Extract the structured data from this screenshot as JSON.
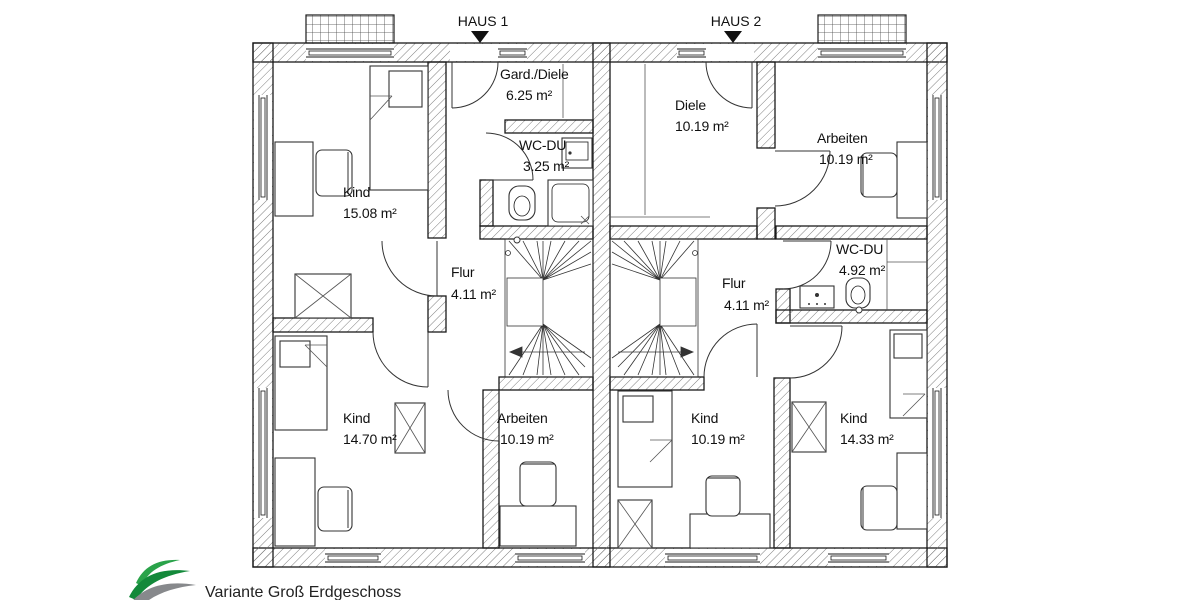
{
  "header": {
    "haus1_label": "HAUS 1",
    "haus2_label": "HAUS 2"
  },
  "rooms": [
    {
      "name": "Kind",
      "area": "15.08 m²"
    },
    {
      "name": "Gard./Diele",
      "area": "6.25 m²"
    },
    {
      "name": "WC-DU",
      "area": "3.25 m²"
    },
    {
      "name": "Flur",
      "area": "4.11 m²"
    },
    {
      "name": "Kind",
      "area": "14.70 m²"
    },
    {
      "name": "Arbeiten",
      "area": "10.19 m²"
    },
    {
      "name": "Diele",
      "area": "10.19 m²"
    },
    {
      "name": "Arbeiten",
      "area": "10.19 m²"
    },
    {
      "name": "WC-DU",
      "area": "4.92 m²"
    },
    {
      "name": "Flur",
      "area": "4.11 m²"
    },
    {
      "name": "Kind",
      "area": "10.19 m²"
    },
    {
      "name": "Kind",
      "area": "14.33 m²"
    }
  ],
  "footer": {
    "caption": "Variante Groß Erdgeschoss"
  },
  "colors": {
    "wall_line": "#1a1a1a",
    "hatch": "#6f6f6f",
    "logo_green_1": "#2aa34a",
    "logo_green_2": "#13893a",
    "logo_gray": "#87898c"
  }
}
